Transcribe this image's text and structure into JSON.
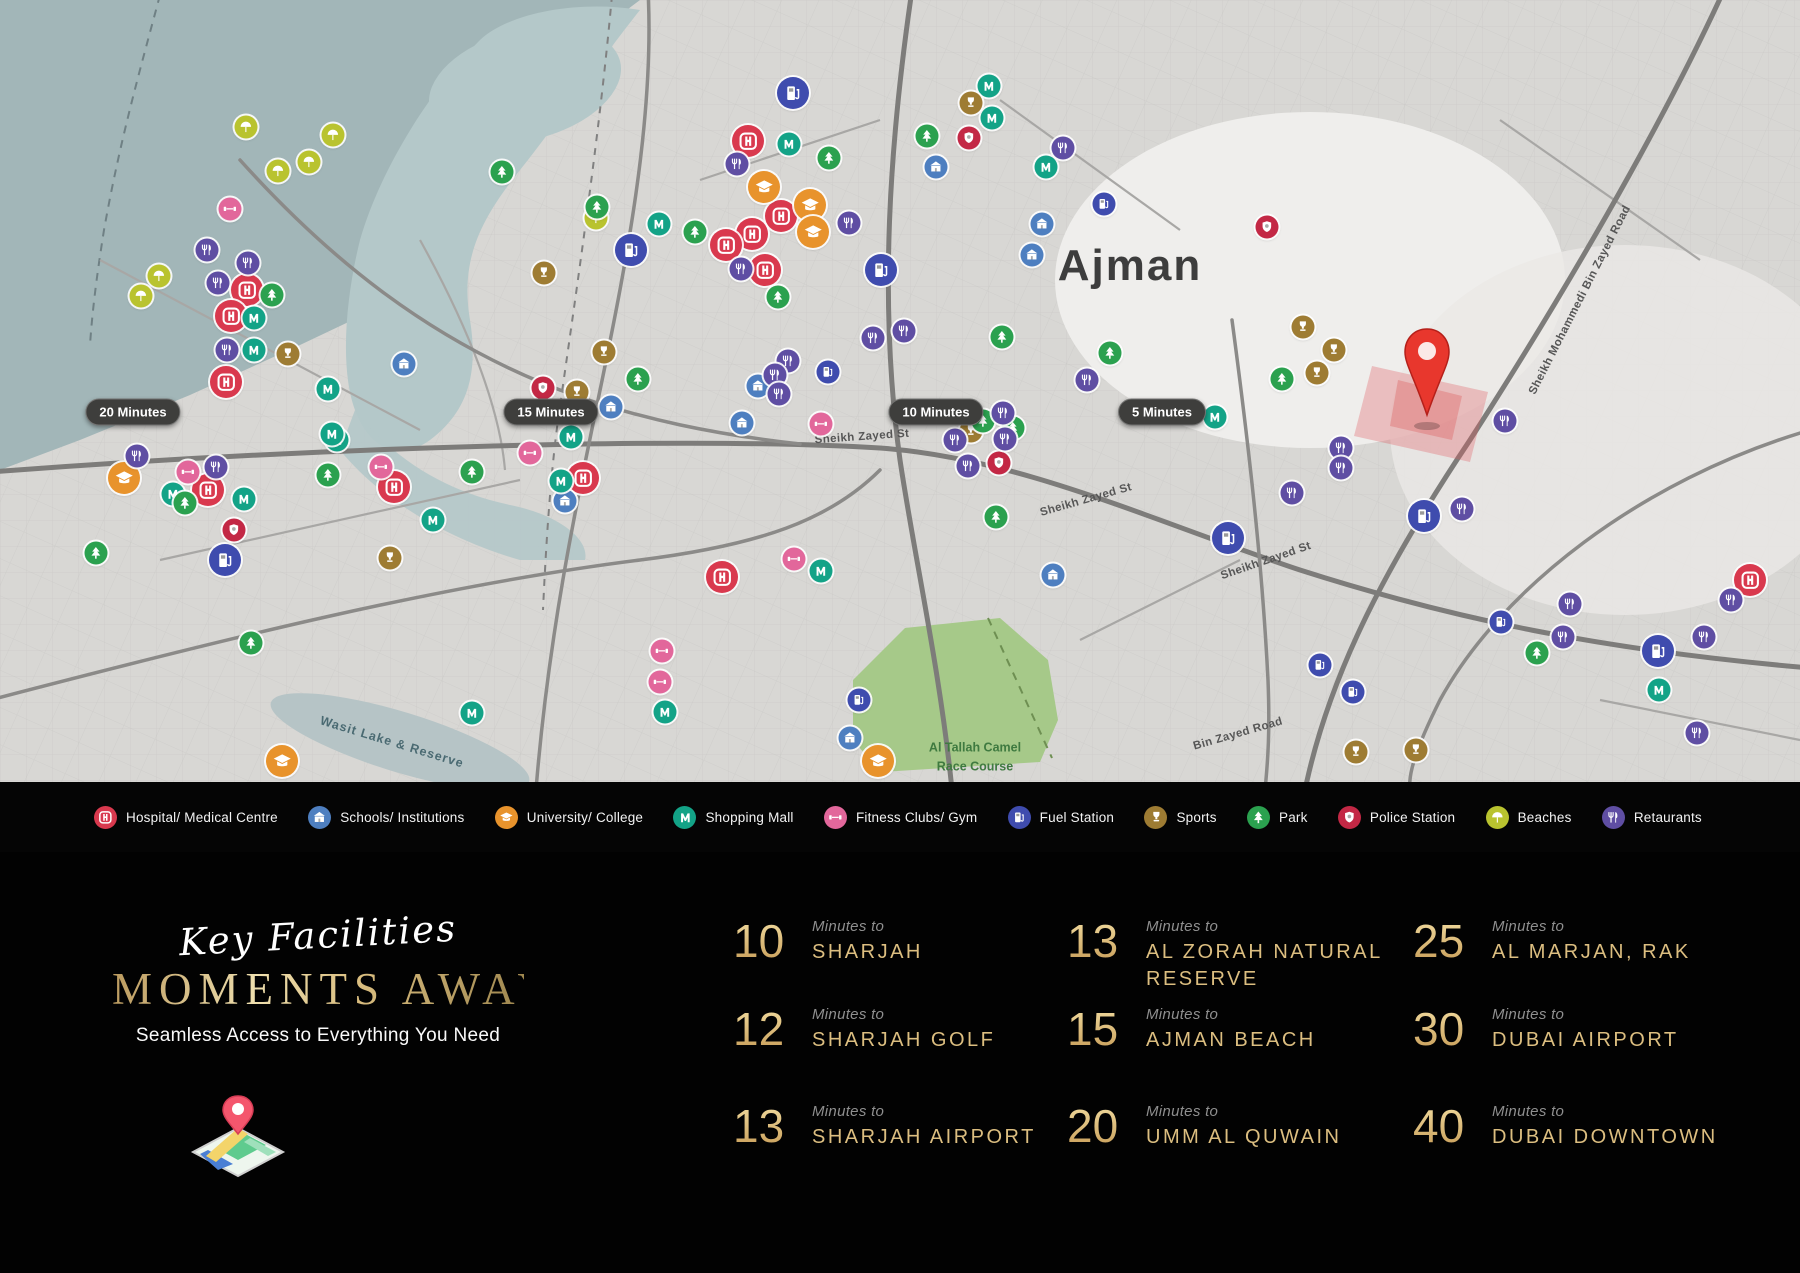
{
  "colors": {
    "gold": "#dcbe80",
    "pin_red": "#e8372d",
    "land": "#d8d7d4",
    "sea": "#a2b6b8"
  },
  "map": {
    "labels": [
      {
        "id": "city-name",
        "text": "Ajman",
        "x": 1130,
        "y": 266,
        "rot": 0,
        "cls": "city"
      },
      {
        "id": "road-sheikh-zayed-1",
        "text": "Sheikh Zayed St",
        "x": 862,
        "y": 437,
        "rot": -4,
        "cls": "road"
      },
      {
        "id": "road-sheikh-zayed-2",
        "text": "Sheikh Zayed St",
        "x": 1086,
        "y": 500,
        "rot": -16,
        "cls": "road"
      },
      {
        "id": "road-sheikh-zayed-3",
        "text": "Sheikh Zayed St",
        "x": 1266,
        "y": 561,
        "rot": -19,
        "cls": "road"
      },
      {
        "id": "road-smbz",
        "text": "Sheikh Mohammedi Bin Zayed Road",
        "x": 1580,
        "y": 300,
        "rot": -63,
        "cls": "road"
      },
      {
        "id": "road-bin-zayed",
        "text": "Bin Zayed Road",
        "x": 1238,
        "y": 734,
        "rot": -16,
        "cls": "road"
      },
      {
        "id": "wasit-lake",
        "text": "Wasit Lake & Reserve",
        "x": 392,
        "y": 742,
        "rot": 17,
        "cls": "water"
      },
      {
        "id": "camel-course",
        "text": "Al Tallah Camel\nRace Course",
        "x": 975,
        "y": 757,
        "rot": 0,
        "cls": "green"
      }
    ],
    "time_badges": [
      {
        "label": "20 Minutes",
        "x": 133,
        "y": 412
      },
      {
        "label": "15 Minutes",
        "x": 551,
        "y": 412
      },
      {
        "label": "10 Minutes",
        "x": 936,
        "y": 412
      },
      {
        "label": "5 Minutes",
        "x": 1162,
        "y": 412
      }
    ],
    "pin": {
      "x": 1427,
      "y": 424
    },
    "markers": [
      {
        "t": "beach",
        "x": 246,
        "y": 127
      },
      {
        "t": "beach",
        "x": 333,
        "y": 135
      },
      {
        "t": "beach",
        "x": 278,
        "y": 171
      },
      {
        "t": "beach",
        "x": 309,
        "y": 162
      },
      {
        "t": "beach",
        "x": 159,
        "y": 276
      },
      {
        "t": "beach",
        "x": 141,
        "y": 296
      },
      {
        "t": "beach",
        "x": 596,
        "y": 218
      },
      {
        "t": "hospital",
        "x": 247,
        "y": 290,
        "lg": 1
      },
      {
        "t": "hospital",
        "x": 231,
        "y": 316,
        "lg": 1
      },
      {
        "t": "hospital",
        "x": 226,
        "y": 382,
        "lg": 1
      },
      {
        "t": "hospital",
        "x": 208,
        "y": 490,
        "lg": 1
      },
      {
        "t": "hospital",
        "x": 394,
        "y": 487,
        "lg": 1
      },
      {
        "t": "hospital",
        "x": 748,
        "y": 141,
        "lg": 1
      },
      {
        "t": "hospital",
        "x": 781,
        "y": 216,
        "lg": 1
      },
      {
        "t": "hospital",
        "x": 752,
        "y": 234,
        "lg": 1
      },
      {
        "t": "hospital",
        "x": 726,
        "y": 245,
        "lg": 1
      },
      {
        "t": "hospital",
        "x": 765,
        "y": 270,
        "lg": 1
      },
      {
        "t": "hospital",
        "x": 722,
        "y": 577,
        "lg": 1
      },
      {
        "t": "hospital",
        "x": 583,
        "y": 478,
        "lg": 1
      },
      {
        "t": "hospital",
        "x": 1750,
        "y": 580,
        "lg": 1
      },
      {
        "t": "school",
        "x": 404,
        "y": 364
      },
      {
        "t": "school",
        "x": 565,
        "y": 501
      },
      {
        "t": "school",
        "x": 611,
        "y": 407
      },
      {
        "t": "school",
        "x": 758,
        "y": 386
      },
      {
        "t": "school",
        "x": 742,
        "y": 423
      },
      {
        "t": "school",
        "x": 936,
        "y": 167
      },
      {
        "t": "school",
        "x": 1042,
        "y": 224
      },
      {
        "t": "school",
        "x": 1032,
        "y": 255
      },
      {
        "t": "school",
        "x": 1053,
        "y": 575
      },
      {
        "t": "school",
        "x": 850,
        "y": 738
      },
      {
        "t": "university",
        "x": 764,
        "y": 187,
        "lg": 1
      },
      {
        "t": "university",
        "x": 810,
        "y": 205,
        "lg": 1
      },
      {
        "t": "university",
        "x": 813,
        "y": 232,
        "lg": 1
      },
      {
        "t": "university",
        "x": 124,
        "y": 478,
        "lg": 1
      },
      {
        "t": "university",
        "x": 282,
        "y": 761,
        "lg": 1
      },
      {
        "t": "university",
        "x": 878,
        "y": 761,
        "lg": 1
      },
      {
        "t": "mall",
        "x": 989,
        "y": 86
      },
      {
        "t": "mall",
        "x": 992,
        "y": 118
      },
      {
        "t": "mall",
        "x": 789,
        "y": 144
      },
      {
        "t": "mall",
        "x": 1046,
        "y": 167
      },
      {
        "t": "mall",
        "x": 659,
        "y": 224
      },
      {
        "t": "mall",
        "x": 254,
        "y": 318
      },
      {
        "t": "mall",
        "x": 254,
        "y": 350
      },
      {
        "t": "mall",
        "x": 328,
        "y": 389
      },
      {
        "t": "mall",
        "x": 337,
        "y": 440
      },
      {
        "t": "mall",
        "x": 571,
        "y": 437
      },
      {
        "t": "mall",
        "x": 561,
        "y": 481
      },
      {
        "t": "mall",
        "x": 173,
        "y": 494
      },
      {
        "t": "mall",
        "x": 244,
        "y": 499
      },
      {
        "t": "mall",
        "x": 433,
        "y": 520
      },
      {
        "t": "mall",
        "x": 472,
        "y": 713
      },
      {
        "t": "mall",
        "x": 332,
        "y": 434
      },
      {
        "t": "mall",
        "x": 1215,
        "y": 417
      },
      {
        "t": "mall",
        "x": 1659,
        "y": 690
      },
      {
        "t": "mall",
        "x": 821,
        "y": 571
      },
      {
        "t": "mall",
        "x": 665,
        "y": 712
      },
      {
        "t": "fitness",
        "x": 230,
        "y": 209
      },
      {
        "t": "fitness",
        "x": 381,
        "y": 467
      },
      {
        "t": "fitness",
        "x": 188,
        "y": 472
      },
      {
        "t": "fitness",
        "x": 530,
        "y": 453
      },
      {
        "t": "fitness",
        "x": 662,
        "y": 651
      },
      {
        "t": "fitness",
        "x": 660,
        "y": 682
      },
      {
        "t": "fitness",
        "x": 821,
        "y": 424
      },
      {
        "t": "fitness",
        "x": 794,
        "y": 559
      },
      {
        "t": "fuel",
        "x": 793,
        "y": 93,
        "lg": 1
      },
      {
        "t": "fuel",
        "x": 881,
        "y": 270,
        "lg": 1
      },
      {
        "t": "fuel",
        "x": 631,
        "y": 250,
        "lg": 1
      },
      {
        "t": "fuel",
        "x": 828,
        "y": 372
      },
      {
        "t": "fuel",
        "x": 859,
        "y": 700
      },
      {
        "t": "fuel",
        "x": 1104,
        "y": 204
      },
      {
        "t": "fuel",
        "x": 1228,
        "y": 538,
        "lg": 1
      },
      {
        "t": "fuel",
        "x": 1424,
        "y": 516,
        "lg": 1
      },
      {
        "t": "fuel",
        "x": 225,
        "y": 560,
        "lg": 1
      },
      {
        "t": "fuel",
        "x": 1501,
        "y": 622
      },
      {
        "t": "fuel",
        "x": 1320,
        "y": 665
      },
      {
        "t": "fuel",
        "x": 1353,
        "y": 692
      },
      {
        "t": "fuel",
        "x": 1658,
        "y": 651,
        "lg": 1
      },
      {
        "t": "sports",
        "x": 971,
        "y": 103
      },
      {
        "t": "sports",
        "x": 544,
        "y": 273
      },
      {
        "t": "sports",
        "x": 288,
        "y": 354
      },
      {
        "t": "sports",
        "x": 604,
        "y": 352
      },
      {
        "t": "sports",
        "x": 577,
        "y": 392
      },
      {
        "t": "sports",
        "x": 971,
        "y": 431
      },
      {
        "t": "sports",
        "x": 390,
        "y": 558
      },
      {
        "t": "sports",
        "x": 1303,
        "y": 327
      },
      {
        "t": "sports",
        "x": 1334,
        "y": 350
      },
      {
        "t": "sports",
        "x": 1317,
        "y": 373
      },
      {
        "t": "sports",
        "x": 1356,
        "y": 752
      },
      {
        "t": "sports",
        "x": 1416,
        "y": 750
      },
      {
        "t": "park",
        "x": 502,
        "y": 172
      },
      {
        "t": "park",
        "x": 597,
        "y": 207
      },
      {
        "t": "park",
        "x": 272,
        "y": 295
      },
      {
        "t": "park",
        "x": 695,
        "y": 232
      },
      {
        "t": "park",
        "x": 829,
        "y": 158
      },
      {
        "t": "park",
        "x": 927,
        "y": 136
      },
      {
        "t": "park",
        "x": 778,
        "y": 297
      },
      {
        "t": "park",
        "x": 638,
        "y": 379
      },
      {
        "t": "park",
        "x": 996,
        "y": 517
      },
      {
        "t": "park",
        "x": 1002,
        "y": 337
      },
      {
        "t": "park",
        "x": 1110,
        "y": 353
      },
      {
        "t": "park",
        "x": 983,
        "y": 421
      },
      {
        "t": "park",
        "x": 1013,
        "y": 428
      },
      {
        "t": "park",
        "x": 472,
        "y": 472
      },
      {
        "t": "park",
        "x": 328,
        "y": 475
      },
      {
        "t": "park",
        "x": 185,
        "y": 503
      },
      {
        "t": "park",
        "x": 96,
        "y": 553
      },
      {
        "t": "park",
        "x": 251,
        "y": 643
      },
      {
        "t": "park",
        "x": 1537,
        "y": 653
      },
      {
        "t": "park",
        "x": 1282,
        "y": 379
      },
      {
        "t": "police",
        "x": 969,
        "y": 138
      },
      {
        "t": "police",
        "x": 1267,
        "y": 227
      },
      {
        "t": "police",
        "x": 543,
        "y": 388
      },
      {
        "t": "police",
        "x": 999,
        "y": 463
      },
      {
        "t": "police",
        "x": 234,
        "y": 530
      },
      {
        "t": "restaurant",
        "x": 207,
        "y": 250
      },
      {
        "t": "restaurant",
        "x": 248,
        "y": 263
      },
      {
        "t": "restaurant",
        "x": 218,
        "y": 283
      },
      {
        "t": "restaurant",
        "x": 227,
        "y": 350
      },
      {
        "t": "restaurant",
        "x": 137,
        "y": 456
      },
      {
        "t": "restaurant",
        "x": 216,
        "y": 467
      },
      {
        "t": "restaurant",
        "x": 737,
        "y": 164
      },
      {
        "t": "restaurant",
        "x": 849,
        "y": 223
      },
      {
        "t": "restaurant",
        "x": 741,
        "y": 269
      },
      {
        "t": "restaurant",
        "x": 1063,
        "y": 148
      },
      {
        "t": "restaurant",
        "x": 873,
        "y": 338
      },
      {
        "t": "restaurant",
        "x": 904,
        "y": 331
      },
      {
        "t": "restaurant",
        "x": 788,
        "y": 361
      },
      {
        "t": "restaurant",
        "x": 775,
        "y": 375
      },
      {
        "t": "restaurant",
        "x": 779,
        "y": 394
      },
      {
        "t": "restaurant",
        "x": 955,
        "y": 440
      },
      {
        "t": "restaurant",
        "x": 968,
        "y": 466
      },
      {
        "t": "restaurant",
        "x": 1003,
        "y": 413
      },
      {
        "t": "restaurant",
        "x": 1087,
        "y": 380
      },
      {
        "t": "restaurant",
        "x": 1005,
        "y": 439
      },
      {
        "t": "restaurant",
        "x": 1341,
        "y": 448
      },
      {
        "t": "restaurant",
        "x": 1341,
        "y": 468
      },
      {
        "t": "restaurant",
        "x": 1292,
        "y": 493
      },
      {
        "t": "restaurant",
        "x": 1462,
        "y": 509
      },
      {
        "t": "restaurant",
        "x": 1505,
        "y": 421
      },
      {
        "t": "restaurant",
        "x": 1570,
        "y": 604
      },
      {
        "t": "restaurant",
        "x": 1563,
        "y": 637
      },
      {
        "t": "restaurant",
        "x": 1731,
        "y": 600
      },
      {
        "t": "restaurant",
        "x": 1704,
        "y": 637
      },
      {
        "t": "restaurant",
        "x": 1697,
        "y": 733
      }
    ]
  },
  "legend": {
    "items": [
      {
        "id": "hospital",
        "label": "Hospital/ Medical Centre",
        "color": "#d9394e"
      },
      {
        "id": "school",
        "label": "Schools/ Institutions",
        "color": "#4e7fc0"
      },
      {
        "id": "university",
        "label": "University/ College",
        "color": "#e8932c"
      },
      {
        "id": "mall",
        "label": "Shopping Mall",
        "color": "#13a387"
      },
      {
        "id": "fitness",
        "label": "Fitness Clubs/ Gym",
        "color": "#e2679b"
      },
      {
        "id": "fuel",
        "label": "Fuel Station",
        "color": "#3f4cae"
      },
      {
        "id": "sports",
        "label": "Sports",
        "color": "#9e7c33"
      },
      {
        "id": "park",
        "label": "Park",
        "color": "#2ba14f"
      },
      {
        "id": "police",
        "label": "Police Station",
        "color": "#c32845"
      },
      {
        "id": "beach",
        "label": "Beaches",
        "color": "#b9c32f"
      },
      {
        "id": "restaurant",
        "label": "Retaurants",
        "color": "#5f4ea3"
      }
    ]
  },
  "section": {
    "script_heading": "Key Facilities",
    "main_heading": "MOMENTS AWAY",
    "subheading": "Seamless Access to Everything You Need"
  },
  "destinations": [
    {
      "minutes": "10",
      "prefix": "Minutes to",
      "name": "SHARJAH"
    },
    {
      "minutes": "12",
      "prefix": "Minutes to",
      "name": "SHARJAH GOLF"
    },
    {
      "minutes": "13",
      "prefix": "Minutes to",
      "name": "SHARJAH AIRPORT"
    },
    {
      "minutes": "13",
      "prefix": "Minutes to",
      "name": "AL ZORAH NATURAL RESERVE"
    },
    {
      "minutes": "15",
      "prefix": "Minutes to",
      "name": "AJMAN BEACH"
    },
    {
      "minutes": "20",
      "prefix": "Minutes to",
      "name": "UMM AL QUWAIN"
    },
    {
      "minutes": "25",
      "prefix": "Minutes to",
      "name": "AL MARJAN, RAK"
    },
    {
      "minutes": "30",
      "prefix": "Minutes to",
      "name": "DUBAI AIRPORT"
    },
    {
      "minutes": "40",
      "prefix": "Minutes to",
      "name": "DUBAI DOWNTOWN"
    }
  ]
}
